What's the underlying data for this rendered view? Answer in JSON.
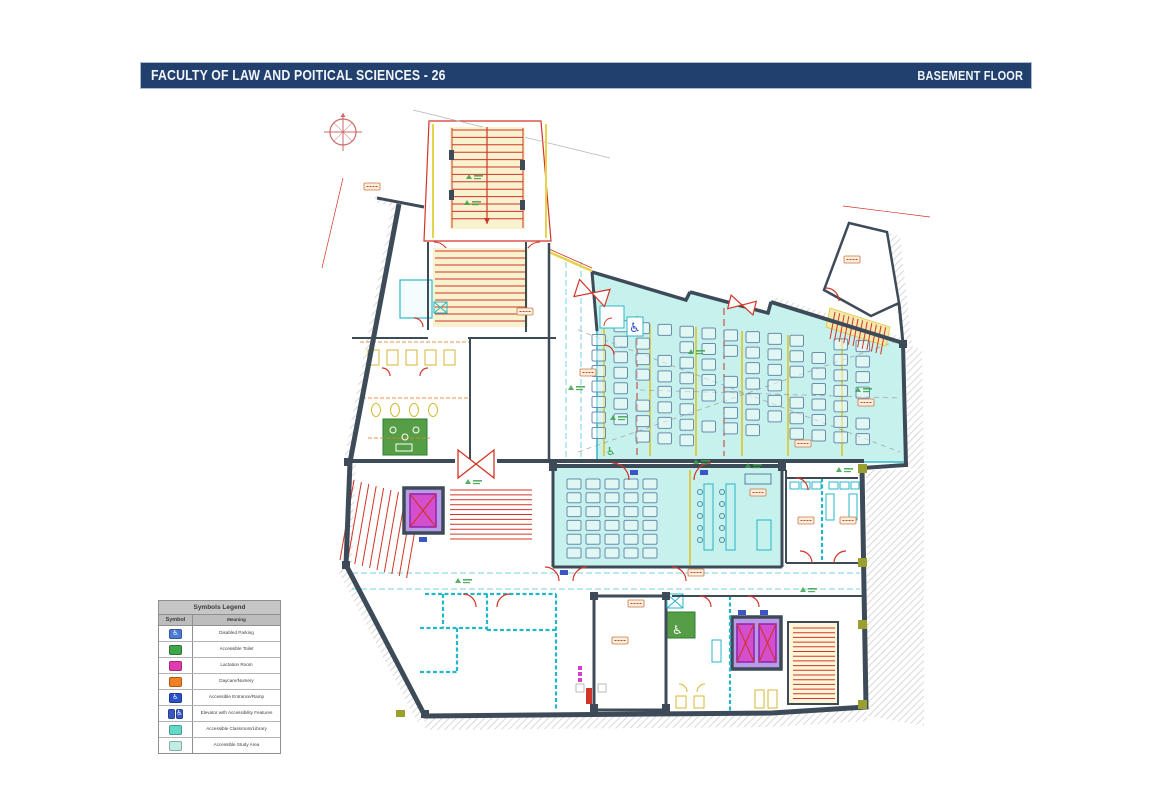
{
  "header": {
    "title": "FACULTY OF LAW AND POITICAL SCIENCES - 26",
    "floor_label": "BASEMENT FLOOR",
    "bar_color": "#21406e"
  },
  "legend": {
    "title": "Symbols Legend",
    "columns": {
      "symbol": "Symbol",
      "meaning": "Meaning"
    },
    "rows": [
      {
        "icon": "disabled-parking-icon",
        "color": "#4a7bd4",
        "meaning": "Disabled Parking"
      },
      {
        "icon": "accessible-toilet-icon",
        "color": "#3fa54a",
        "meaning": "Accessible Toilet"
      },
      {
        "icon": "lactation-room-icon",
        "color": "#e23ab0",
        "meaning": "Lactation Room"
      },
      {
        "icon": "daycare-nursery-icon",
        "color": "#f08020",
        "meaning": "Daycare/Nursery"
      },
      {
        "icon": "accessible-entrance-ramp-icon",
        "color": "#2a50c8",
        "meaning": "Accessible Entrance/Ramp"
      },
      {
        "icon": "accessible-elevator-icon",
        "color": "#3858c8",
        "color2": "#9038c8",
        "meaning": "Elevator with Accessibility Features"
      },
      {
        "icon": "accessible-classroom-icon",
        "color": "#62d8c8",
        "meaning": "Accessible Classroom/Library"
      },
      {
        "icon": "accessible-study-area-icon",
        "color": "#bfeee6",
        "meaning": "Accessible Study Area"
      }
    ]
  },
  "plan": {
    "colors": {
      "wall": "#3d4b59",
      "room_fill": "#c6f1ec",
      "accent_red": "#d23527",
      "accent_yellow": "#ddca3a",
      "accent_teal": "#23b7c9",
      "elevator_car": "#d44fd0",
      "elevator_shaft": "#b89ae8",
      "accessible_room": "#569e46",
      "hatch": "#cfcfcf"
    }
  }
}
